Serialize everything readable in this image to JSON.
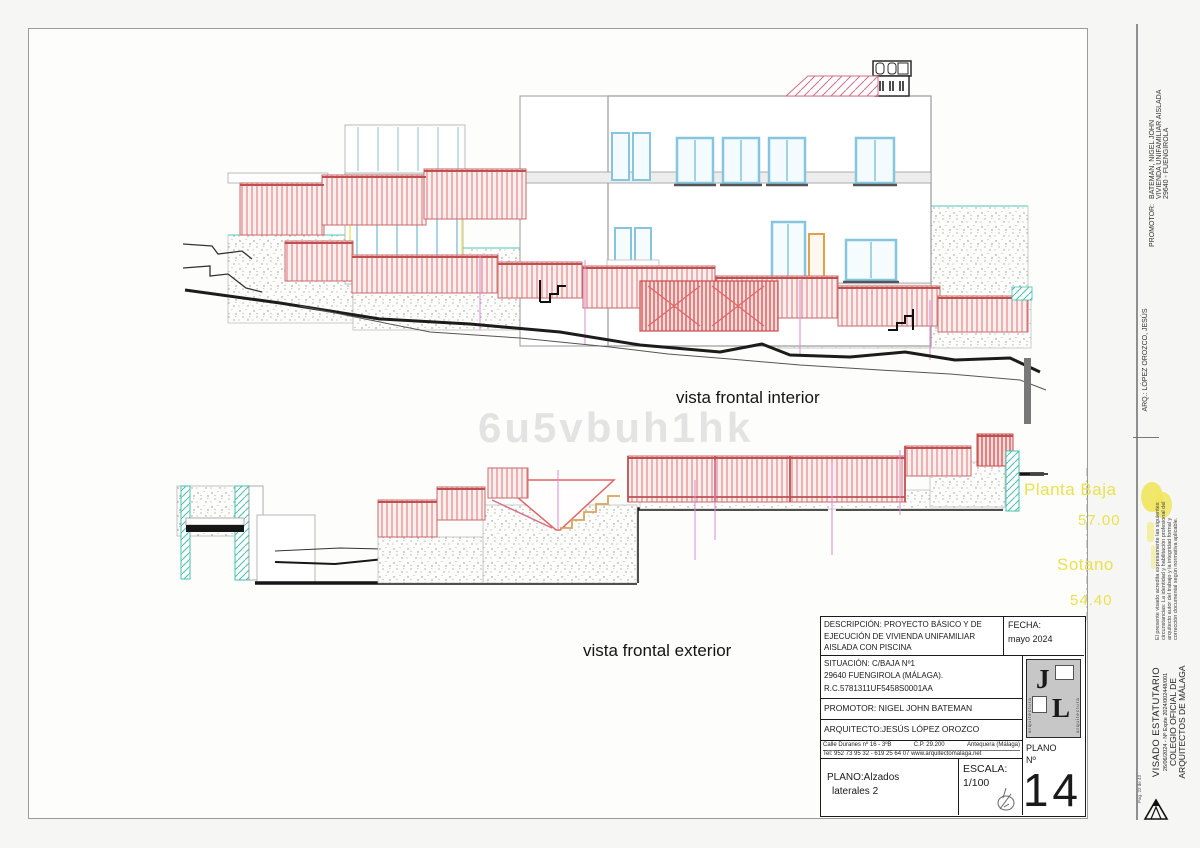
{
  "sheet": {
    "watermark": "6u5vbuh1hk",
    "labels": {
      "top_view": "vista frontal interior",
      "bottom_view": "vista frontal exterior"
    },
    "levels": {
      "planta_baja_label": "Planta Baja",
      "planta_baja_value": "57.00",
      "sotano_label": "Sotano",
      "sotano_value": "54.40"
    }
  },
  "title_block": {
    "descripcion_line1": "DESCRIPCIÓN: PROYECTO BÁSICO Y DE",
    "descripcion_line2": "EJECUCIÓN DE VIVIENDA UNIFAMILIAR",
    "descripcion_line3": "AISLADA CON PISCINA",
    "fecha_label": "FECHA:",
    "fecha_value": "mayo  2024",
    "situacion_line1": "SITUACIÓN:  C/BAJA Nº1",
    "situacion_line2": "29640 FUENGIROLA (MÁLAGA).",
    "situacion_line3": "R.C.5781311UF5458S0001AA",
    "promotor": "PROMOTOR: NIGEL JOHN BATEMAN",
    "arquitecto": "ARQUITECTO:JESÚS LÓPEZ OROZCO",
    "address_l1a": "Calle Duranes nº 16 - 3ºB",
    "address_l1b": "C.P. 29.200",
    "address_l1c": "Antequera (Málaga)",
    "address_line2": "Tel: 952 73 95 32 - 619 25 64 07 www.arquitectomalaga.net",
    "plano_label": "PLANO:Alzados",
    "plano_label2": "laterales 2",
    "escala_label": "ESCALA:",
    "escala_value": "1/100",
    "plano_num_label1": "PLANO",
    "plano_num_label2": "Nº",
    "plano_num": "14",
    "logo_j": "J",
    "logo_l": "L",
    "logo_side_text": "arquitectura"
  },
  "right_margin": {
    "arq_line": "ARQ.: LÓPEZ OROZCO, JESÚS",
    "promotor_label": "PROMOTOR:",
    "promotor_line1": "BATEMAN, NIGEL JOHN",
    "promotor_line2": "VIVIENDA UNIFAMILIAR AISLADA",
    "promotor_line3": "29640 - FUENGIROLA",
    "visado_title": "VISADO ESTATUTARIO",
    "visado_expediente": "26/06/2024 - Nº Expte 2024/002448/001",
    "visado_line3": "COLEGIO OFICIAL DE",
    "visado_line4": "ARQUITECTOS DE MÁLAGA",
    "disclaimer_line1": "El presente visado acredita expresamente las siguientes",
    "disclaimer_line2": "circunstancias: La identidad y habilitación profesional del",
    "disclaimer_line3": "arquitecto autor del trabajo y la integridad formal y",
    "disclaimer_line4": "corrección documental según normativa aplicable.",
    "page_note": "Pag. 22 de 43"
  },
  "colors": {
    "railing_pink": "#e07878",
    "railing_dark": "#c05050",
    "window_blue": "#85c6de",
    "cyan_hatch": "#46c0b0",
    "level_yellow": "#e9e14e",
    "highlight_yellow": "#f2e55e",
    "terrain_black": "#1c1c1c"
  }
}
